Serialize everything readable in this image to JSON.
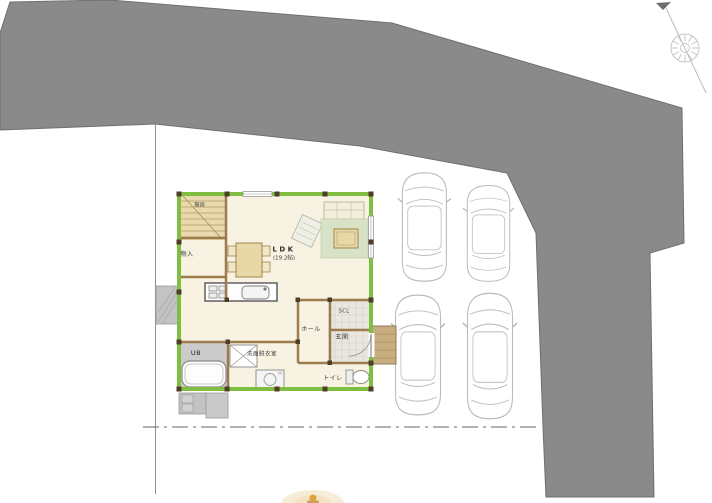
{
  "floor_plan": {
    "labels": {
      "stairs": "階段",
      "storage": "物入",
      "ldk_title": "LDK",
      "ldk_size": "(19.2帖)",
      "hall": "ホール",
      "shoe_closet": "SCL",
      "entrance": "玄関",
      "toilet": "トイレ",
      "washroom": "洗面脱衣室",
      "unit_bath": "UB"
    }
  },
  "site": {
    "parking_car_outlines": 4,
    "icons": {
      "compass": "compass-rose-with-north-line"
    },
    "colors": {
      "road": "#8a8a8a",
      "road_edge": "#6f6f6f",
      "exterior_wall_green": "#7fbe41",
      "wall_post_brown": "#4e3d28",
      "interior_wall_tan": "#9c7c4c",
      "floor_cream": "#f7f2e2",
      "stairs_tan": "#ead9ad",
      "rug_green": "#d8e2c6",
      "furniture_tan": "#e8d8a8",
      "entry_tile": "#e9e7df",
      "bath_floor_gray": "#cbcbcb",
      "porch_tan": "#c8ad7f",
      "car_outline_gray": "#bcbcbc",
      "logo_accent_orange": "#e2a23c"
    }
  }
}
